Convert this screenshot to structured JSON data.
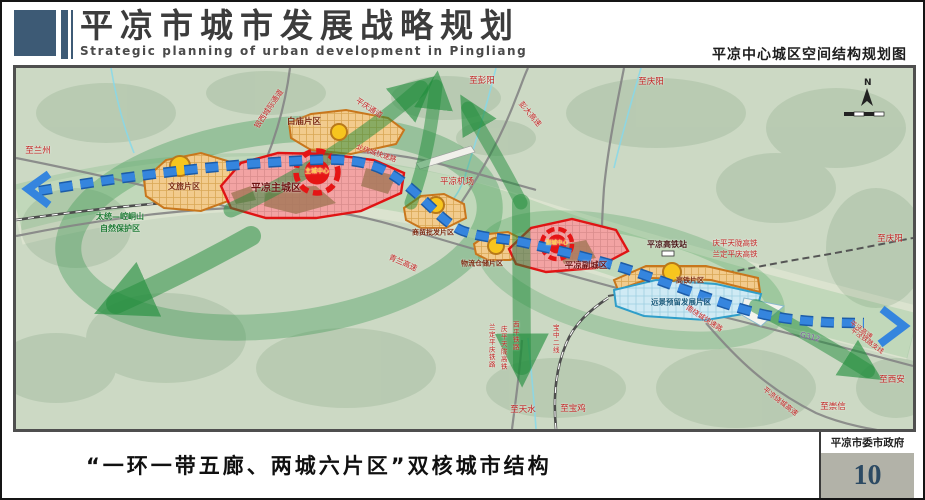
{
  "document": {
    "title_cn": "平凉市城市发展战略规划",
    "title_en": "Strategic planning of urban development in Pingliang",
    "subtitle_right": "平凉中心城区空间结构规划图"
  },
  "footer": {
    "caption": "“一环一带五廊、两城六片区”双核城市结构",
    "org": "平凉市委市政府",
    "page_number": "10"
  },
  "map": {
    "compass_label": "N",
    "colors": {
      "ecology_green": "#1f8c3a",
      "axis_blue": "#3585de",
      "city_red": "#e01414",
      "district_orange": "#c8761c",
      "reserved_blue": "#2f9ec9",
      "header_navy": "#3d5a75",
      "page_number_blue": "#2c4a63"
    },
    "labels": [
      {
        "id": "to-lanzhou",
        "text": "至兰州",
        "x": 22,
        "y": 83,
        "size": 8.5,
        "color": "#c22121"
      },
      {
        "id": "intercity-corridor",
        "text": "银西城际通道",
        "x": 253,
        "y": 41,
        "size": 7.5,
        "color": "#c22121",
        "rotate": -56
      },
      {
        "id": "pingqing-corridor",
        "text": "平庆通道",
        "x": 353,
        "y": 40,
        "size": 7.5,
        "color": "#c22121",
        "rotate": 33
      },
      {
        "id": "baimiao-district",
        "text": "白庙片区",
        "x": 288,
        "y": 54,
        "size": 8.5,
        "color": "#7c2a10",
        "bold": true
      },
      {
        "id": "north-ring-expressway",
        "text": "北绕城快速路",
        "x": 360,
        "y": 86,
        "size": 7,
        "color": "#c22121",
        "rotate": 18
      },
      {
        "id": "to-pengyang",
        "text": "至彭阳",
        "x": 466,
        "y": 13,
        "size": 8.5,
        "color": "#c22121"
      },
      {
        "id": "pengda-expressway",
        "text": "彭大高速",
        "x": 514,
        "y": 46,
        "size": 7.5,
        "color": "#c22121",
        "rotate": 50
      },
      {
        "id": "to-qingyang-north",
        "text": "至庆阳",
        "x": 635,
        "y": 14,
        "size": 8.5,
        "color": "#c22121"
      },
      {
        "id": "pingliang-airport",
        "text": "平凉机场",
        "x": 441,
        "y": 114,
        "size": 8.5,
        "color": "#c22121"
      },
      {
        "id": "main-city",
        "text": "平凉主城区",
        "x": 260,
        "y": 121,
        "size": 10,
        "color": "#6e1111",
        "bold": true
      },
      {
        "id": "main-core",
        "text": "主城中心",
        "x": 301,
        "y": 104,
        "size": 6,
        "color": "#ffd24a",
        "bold": true
      },
      {
        "id": "wenlv-district",
        "text": "文旅片区",
        "x": 168,
        "y": 119,
        "size": 8,
        "color": "#7c2a10",
        "bold": true
      },
      {
        "id": "nature-reserve-line1",
        "text": "太统—崆峒山",
        "x": 104,
        "y": 149,
        "size": 8,
        "color": "#1d7a33",
        "bold": true
      },
      {
        "id": "nature-reserve-line2",
        "text": "自然保护区",
        "x": 104,
        "y": 161,
        "size": 8,
        "color": "#1d7a33",
        "bold": true
      },
      {
        "id": "trade-district",
        "text": "商贸批发片区",
        "x": 417,
        "y": 165,
        "size": 7,
        "color": "#7c2a10",
        "bold": true
      },
      {
        "id": "qinglan-expressway",
        "text": "青兰高速",
        "x": 387,
        "y": 195,
        "size": 7.5,
        "color": "#c22121",
        "rotate": 24
      },
      {
        "id": "logistics-district",
        "text": "物流仓储片区",
        "x": 466,
        "y": 196,
        "size": 7,
        "color": "#7c2a10",
        "bold": true
      },
      {
        "id": "sub-core",
        "text": "副城中心",
        "x": 541,
        "y": 176,
        "size": 5.5,
        "color": "#ffd24a",
        "bold": true
      },
      {
        "id": "sub-city",
        "text": "平凉副城区",
        "x": 570,
        "y": 198,
        "size": 8.5,
        "color": "#6e1111",
        "bold": true
      },
      {
        "id": "hsr-station",
        "text": "平凉高铁站",
        "x": 651,
        "y": 177,
        "size": 8,
        "color": "#4a1717",
        "bold": true
      },
      {
        "id": "qingping-tianlong-hsr",
        "text": "庆平天陇高铁",
        "x": 719,
        "y": 175,
        "size": 7.5,
        "color": "#c22121"
      },
      {
        "id": "landing-pingqing-hsr",
        "text": "兰定平庆高铁",
        "x": 719,
        "y": 186,
        "size": 7.5,
        "color": "#c22121"
      },
      {
        "id": "to-qingyang-east",
        "text": "至庆阳",
        "x": 874,
        "y": 171,
        "size": 8.5,
        "color": "#c22121"
      },
      {
        "id": "hsr-district",
        "text": "高铁片区",
        "x": 674,
        "y": 213,
        "size": 7,
        "color": "#7c2a10",
        "bold": true
      },
      {
        "id": "reserved-district",
        "text": "远景预留发展片区",
        "x": 665,
        "y": 234,
        "size": 7.5,
        "color": "#17597a",
        "bold": true
      },
      {
        "id": "south-ring-expressway",
        "text": "南绕城快速路",
        "x": 688,
        "y": 251,
        "size": 7,
        "color": "#c22121",
        "rotate": 33
      },
      {
        "id": "g312-road",
        "text": "G312",
        "x": 794,
        "y": 269,
        "size": 7.5,
        "color": "#7a5a9a",
        "rotate": 14
      },
      {
        "id": "pingjing-expressway",
        "text": "平泾高速",
        "x": 845,
        "y": 262,
        "size": 6.5,
        "color": "#c22121",
        "rotate": 36
      },
      {
        "id": "pingjing-railway",
        "text": "平泾铁路支线",
        "x": 851,
        "y": 273,
        "size": 6.5,
        "color": "#c22121",
        "rotate": 36
      },
      {
        "id": "to-xian",
        "text": "至西安",
        "x": 876,
        "y": 312,
        "size": 8.5,
        "color": "#c22121"
      },
      {
        "id": "ring-expressway",
        "text": "平凉绕城高速",
        "x": 764,
        "y": 334,
        "size": 7,
        "color": "#c22121",
        "rotate": 38
      },
      {
        "id": "to-chongxin",
        "text": "至崇信",
        "x": 817,
        "y": 339,
        "size": 8.5,
        "color": "#c22121"
      },
      {
        "id": "landing-pingqing-railway-v",
        "text": "兰定平庆铁路",
        "x": 475,
        "y": 278,
        "size": 6.5,
        "color": "#c22121",
        "vertical": true
      },
      {
        "id": "qingping-tianlong-hsr-v",
        "text": "庆平天陇高铁",
        "x": 487,
        "y": 280,
        "size": 6.5,
        "color": "#c22121",
        "vertical": true
      },
      {
        "id": "xiping-railway-v",
        "text": "西平铁路",
        "x": 499,
        "y": 268,
        "size": 6.5,
        "color": "#c22121",
        "vertical": true
      },
      {
        "id": "baozhong-second-line-v",
        "text": "宝中二线",
        "x": 539,
        "y": 271,
        "size": 6.5,
        "color": "#c22121",
        "vertical": true
      },
      {
        "id": "to-tianshui",
        "text": "至天水",
        "x": 507,
        "y": 342,
        "size": 8.5,
        "color": "#c22121"
      },
      {
        "id": "to-baoji",
        "text": "至宝鸡",
        "x": 557,
        "y": 341,
        "size": 8.5,
        "color": "#c22121"
      }
    ]
  }
}
